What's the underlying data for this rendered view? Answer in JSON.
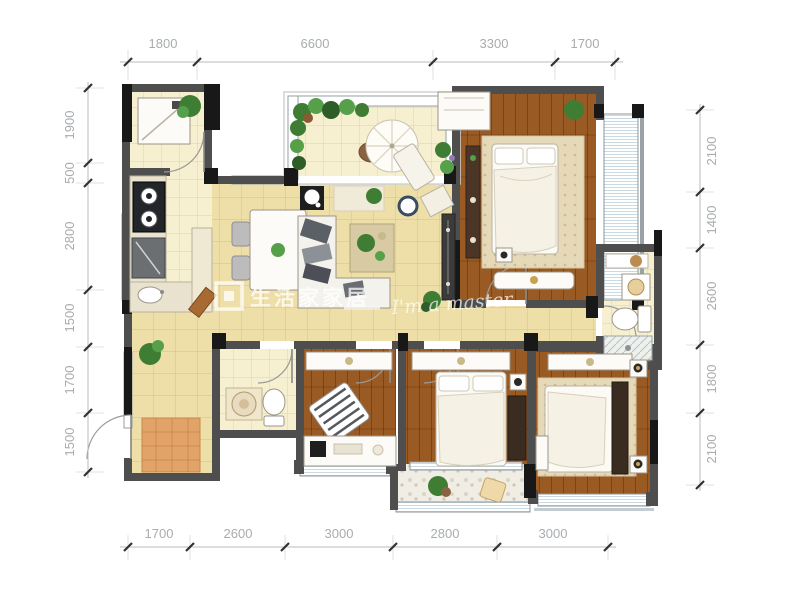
{
  "watermark": {
    "brand": "生活家家居",
    "tagline": "I'm a master"
  },
  "dimensions": {
    "top": [
      "1800",
      "6600",
      "3300",
      "1700"
    ],
    "bottom": [
      "1700",
      "2600",
      "3000",
      "2800",
      "3000"
    ],
    "left": [
      "1900",
      "500",
      "2800",
      "1500",
      "1700",
      "1500"
    ],
    "right": [
      "2100",
      "1400",
      "2600",
      "1800",
      "2100"
    ]
  },
  "colors": {
    "wall": "#4e4e4e",
    "wall_dark": "#181818",
    "floor_tile": "#eedfa9",
    "floor_tile_light": "#f6efd0",
    "wood_floor": "#9a5a24",
    "rug": "#e6d9b8",
    "window_stripe": "#c9dae4",
    "plant": "#3f7d35",
    "dim_text": "#a8acaf",
    "watermark": "#ffffff"
  },
  "icons": [
    "washing-machine",
    "stove",
    "fridge",
    "kitchen-sink",
    "counter",
    "dining-table",
    "dining-chair",
    "floor-fan",
    "sofa",
    "coffee-table",
    "round-stool",
    "media-cabinet",
    "parasol-table",
    "lounge-chair",
    "plant",
    "wardrobe",
    "bed",
    "rug",
    "bench",
    "dresser",
    "nightstand",
    "toilet",
    "basin",
    "shower",
    "shelf",
    "desk",
    "desk-chair",
    "cabinet",
    "door-mat",
    "window",
    "door-arc"
  ]
}
